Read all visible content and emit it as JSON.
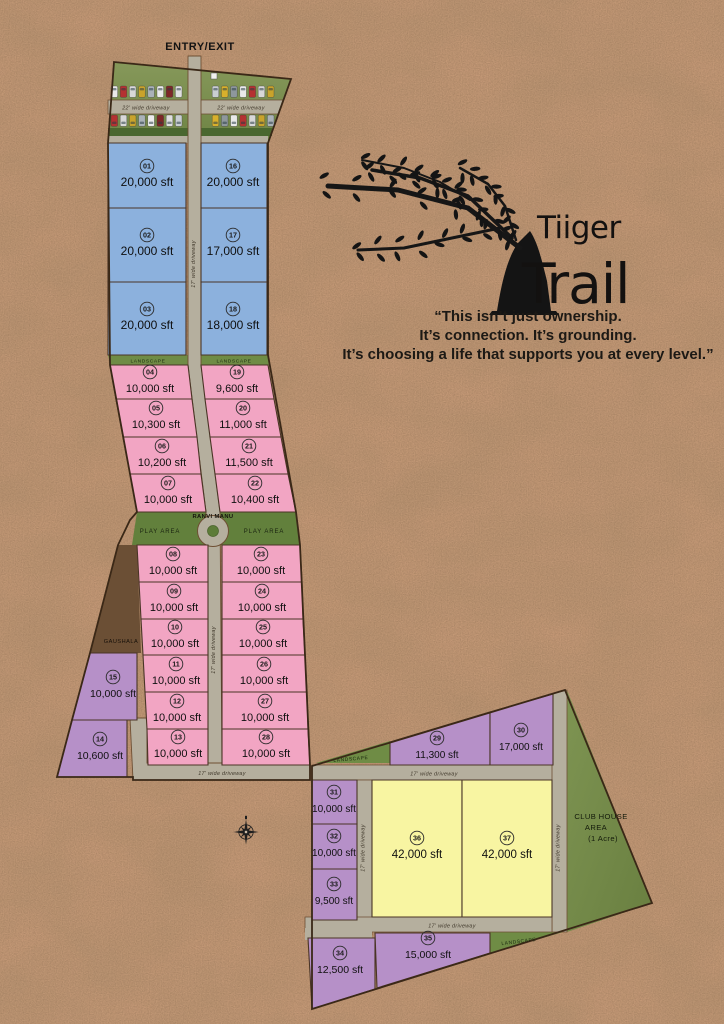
{
  "entry_exit": "ENTRY/EXIT",
  "brand": {
    "line1": "Tiiger",
    "line2": "Trail"
  },
  "quote": {
    "l1": "“This isn’t just ownership.",
    "l2": "It’s connection. It’s grounding.",
    "l3": "It’s choosing a life that supports you at every level.”"
  },
  "labels": {
    "landscape": "LANDSCAPE",
    "play_area": "PLAY AREA",
    "ranvi_manu": "RANVI MANU",
    "gaushala": "GAUSHALA",
    "club_house_1": "CLUB HOUSE",
    "club_house_2": "AREA",
    "club_house_3": "(1 Acre)",
    "driveway_22": "22' wide driveway",
    "driveway_17": "17' wide driveway"
  },
  "colors": {
    "blue": "#8cb1dd",
    "pink": "#f2a5c3",
    "purple": "#b690c8",
    "yellow": "#f8f5a2",
    "road": "#b5af9e",
    "ground": "#c79a78",
    "green": "#7b9150"
  },
  "plots": [
    {
      "num": "01",
      "size": "20,000 sft",
      "type": "blue"
    },
    {
      "num": "02",
      "size": "20,000 sft",
      "type": "blue"
    },
    {
      "num": "03",
      "size": "20,000 sft",
      "type": "blue"
    },
    {
      "num": "04",
      "size": "10,000 sft",
      "type": "pink"
    },
    {
      "num": "05",
      "size": "10,300 sft",
      "type": "pink"
    },
    {
      "num": "06",
      "size": "10,200 sft",
      "type": "pink"
    },
    {
      "num": "07",
      "size": "10,000 sft",
      "type": "pink"
    },
    {
      "num": "08",
      "size": "10,000 sft",
      "type": "pink"
    },
    {
      "num": "09",
      "size": "10,000 sft",
      "type": "pink"
    },
    {
      "num": "10",
      "size": "10,000 sft",
      "type": "pink"
    },
    {
      "num": "11",
      "size": "10,000 sft",
      "type": "pink"
    },
    {
      "num": "12",
      "size": "10,000 sft",
      "type": "pink"
    },
    {
      "num": "13",
      "size": "10,000 sft",
      "type": "pink"
    },
    {
      "num": "14",
      "size": "10,600 sft",
      "type": "purple"
    },
    {
      "num": "15",
      "size": "10,000 sft",
      "type": "purple"
    },
    {
      "num": "16",
      "size": "20,000 sft",
      "type": "blue"
    },
    {
      "num": "17",
      "size": "17,000 sft",
      "type": "blue"
    },
    {
      "num": "18",
      "size": "18,000 sft",
      "type": "blue"
    },
    {
      "num": "19",
      "size": "9,600 sft",
      "type": "pink"
    },
    {
      "num": "20",
      "size": "11,000 sft",
      "type": "pink"
    },
    {
      "num": "21",
      "size": "11,500 sft",
      "type": "pink"
    },
    {
      "num": "22",
      "size": "10,400 sft",
      "type": "pink"
    },
    {
      "num": "23",
      "size": "10,000 sft",
      "type": "pink"
    },
    {
      "num": "24",
      "size": "10,000 sft",
      "type": "pink"
    },
    {
      "num": "25",
      "size": "10,000 sft",
      "type": "pink"
    },
    {
      "num": "26",
      "size": "10,000 sft",
      "type": "pink"
    },
    {
      "num": "27",
      "size": "10,000 sft",
      "type": "pink"
    },
    {
      "num": "28",
      "size": "10,000 sft",
      "type": "pink"
    },
    {
      "num": "29",
      "size": "11,300 sft",
      "type": "purple"
    },
    {
      "num": "30",
      "size": "17,000 sft",
      "type": "purple"
    },
    {
      "num": "31",
      "size": "10,000 sft",
      "type": "purple"
    },
    {
      "num": "32",
      "size": "10,000 sft",
      "type": "purple"
    },
    {
      "num": "33",
      "size": "9,500 sft",
      "type": "purple"
    },
    {
      "num": "34",
      "size": "12,500 sft",
      "type": "purple"
    },
    {
      "num": "35",
      "size": "15,000 sft",
      "type": "purple"
    },
    {
      "num": "36",
      "size": "42,000 sft",
      "type": "yellow"
    },
    {
      "num": "37",
      "size": "42,000 sft",
      "type": "yellow"
    }
  ]
}
